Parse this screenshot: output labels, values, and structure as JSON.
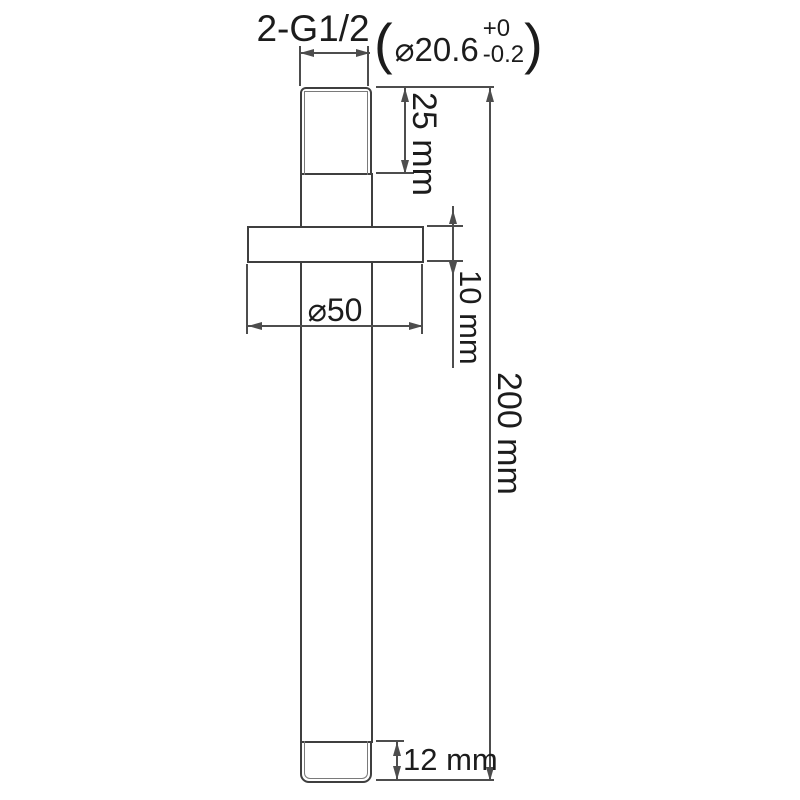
{
  "drawing": {
    "labels": {
      "thread_spec": "2-G1/2",
      "paren_open": "(",
      "bore_diameter": "⌀20.6",
      "tol_upper": "+0",
      "tol_lower": "-0.2",
      "paren_close": ")",
      "dim_thread_top": "25 mm",
      "dim_flange_thickness": "10 mm",
      "dim_flange_diameter": "⌀50",
      "dim_overall_length": "200 mm",
      "dim_thread_bottom": "12 mm"
    },
    "colors": {
      "part_line": "#3f3f3f",
      "dimension_line": "#4d4d4d",
      "text": "#1c1c1c",
      "background": "#ffffff"
    }
  }
}
